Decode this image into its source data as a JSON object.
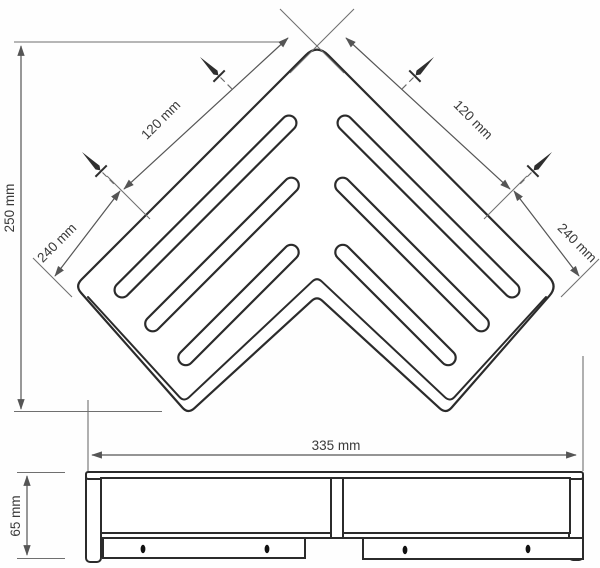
{
  "drawing": {
    "dims": {
      "height": "250 mm",
      "left_screw_to_apex": "120 mm",
      "right_screw_to_apex": "120 mm",
      "left_corner_to_screw": "240 mm",
      "right_corner_to_screw": "240 mm",
      "overall_width": "335 mm",
      "side_height": "65 mm"
    }
  }
}
